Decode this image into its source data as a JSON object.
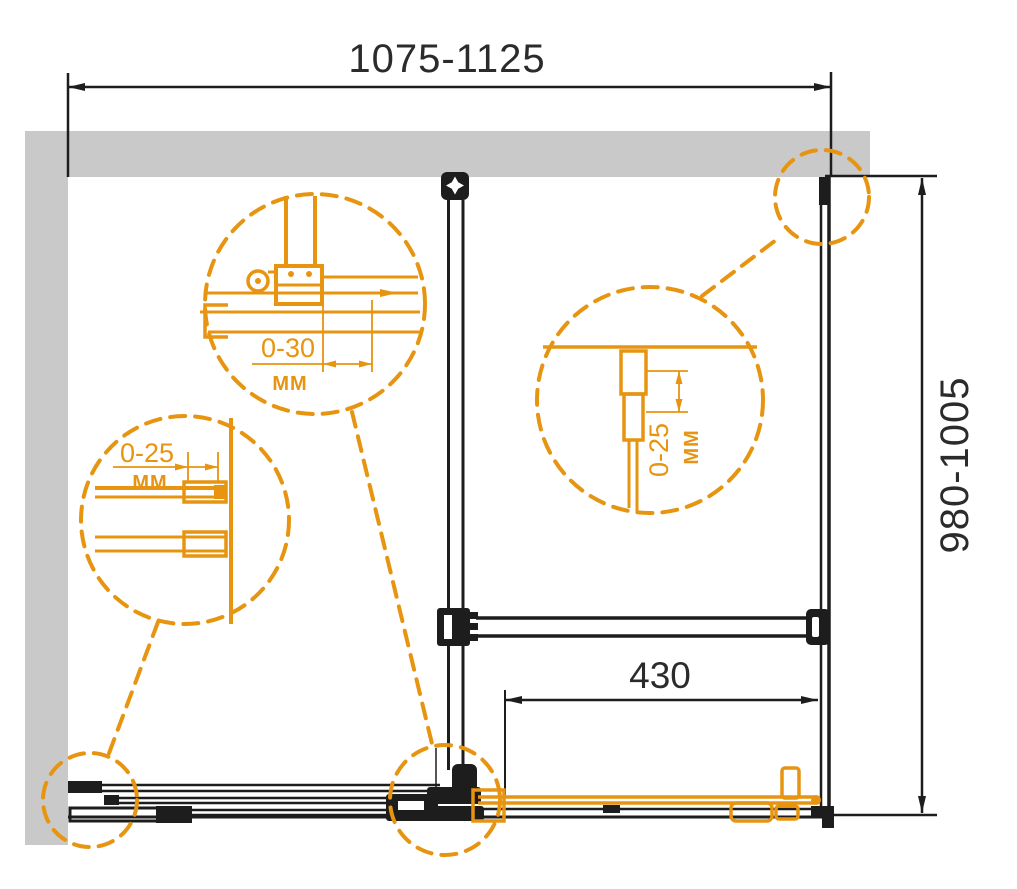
{
  "drawing": {
    "title": "Shower enclosure installation plan",
    "dimensions": {
      "width_range": "1075-1125",
      "depth_range": "980-1005",
      "door_width": "430"
    },
    "details": {
      "top_left": {
        "value": "0-30",
        "unit": "ММ"
      },
      "left_middle": {
        "value": "0-25",
        "unit": "ММ"
      },
      "center_right": {
        "value": "0-25",
        "unit": "ММ"
      }
    },
    "colors": {
      "accent": "#E79410",
      "line": "#1D1D1D",
      "wall": "#C9C9C9",
      "text": "#2B2B2B",
      "background": "#FFFFFF"
    }
  }
}
